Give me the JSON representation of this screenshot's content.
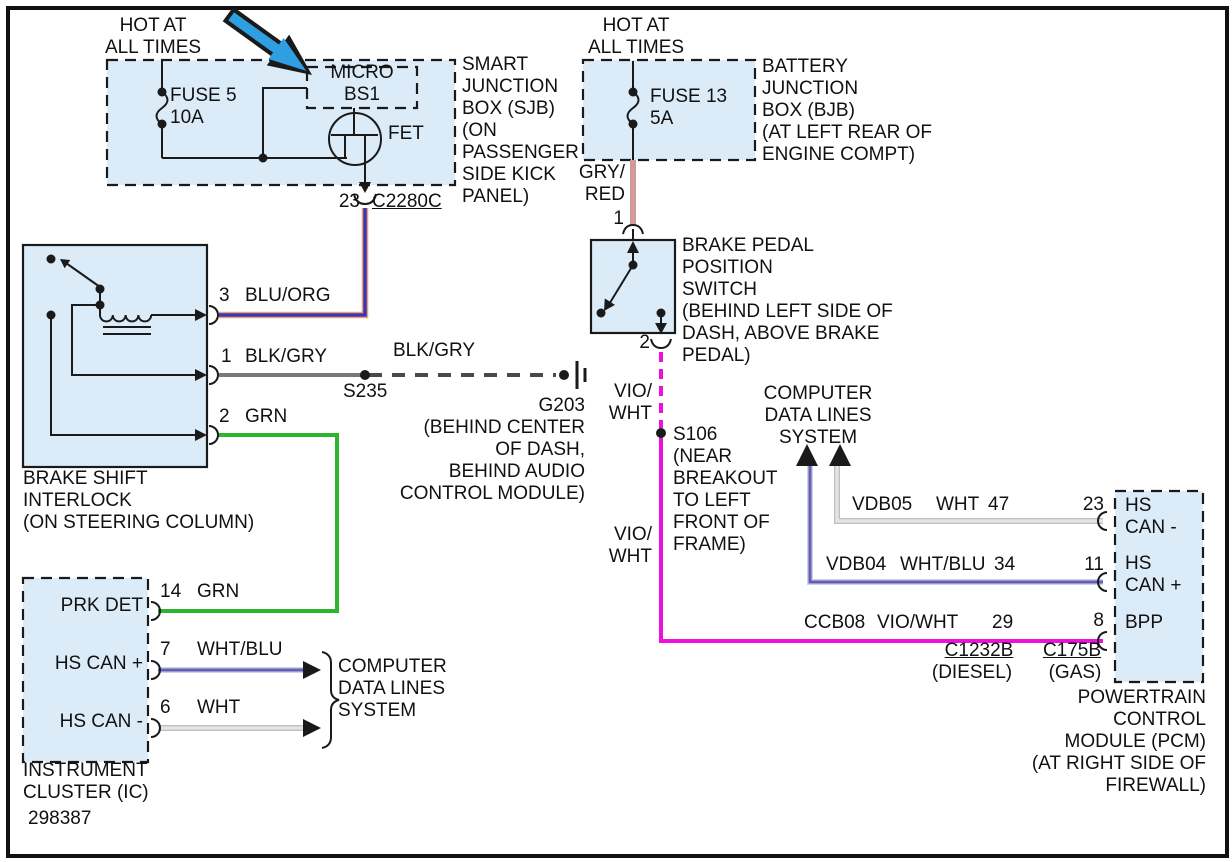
{
  "colors": {
    "line": "#1a1a1a",
    "box_fill": "#dcebf8",
    "wire_blu": "#3a35c0",
    "wire_org": "#e9a469",
    "wire_grn": "#2eb42e",
    "wire_gry": "#787878",
    "wire_blk_gry_dash": "#4a4a4a",
    "wire_gry_red": "#ea9191",
    "wire_gry_red_edge": "#a8a8a8",
    "wire_vio_wht": "#ee10dd",
    "wire_wht": "#e4e4e4",
    "wire_wht_edge": "#bfbfbf",
    "wire_wht_blu": "#6460b4",
    "wire_wht_blu_edge": "#cfcfe8",
    "arrow_blue": "#2e9fe0"
  },
  "sheet_number": "298387",
  "hot_left": {
    "line1": "HOT AT",
    "line2": "ALL TIMES"
  },
  "hot_right": {
    "line1": "HOT AT",
    "line2": "ALL TIMES"
  },
  "sjb": {
    "fuse_name": "FUSE 5",
    "fuse_rating": "10A",
    "micro_line1": "MICRO",
    "micro_line2": "BS1",
    "fet_label": "FET",
    "name_lines": [
      "SMART",
      "JUNCTION",
      "BOX (SJB)",
      "(ON",
      "PASSENGER",
      "SIDE KICK",
      "PANEL)"
    ],
    "pin": "23",
    "connector": "C2280C"
  },
  "bjb": {
    "fuse_name": "FUSE 13",
    "fuse_rating": "5A",
    "name_lines": [
      "BATTERY",
      "JUNCTION",
      "BOX (BJB)",
      "(AT LEFT REAR OF",
      "ENGINE COMPT)"
    ],
    "wire_color_line1": "GRY/",
    "wire_color_line2": "RED",
    "pin": "1"
  },
  "bpp": {
    "pin_bottom": "2",
    "name_lines": [
      "BRAKE PEDAL",
      "POSITION",
      "SWITCH",
      "(BEHIND LEFT SIDE OF",
      "DASH, ABOVE BRAKE",
      "PEDAL)"
    ]
  },
  "vio_label_1": {
    "line1": "VIO/",
    "line2": "WHT"
  },
  "vio_label_2": {
    "line1": "VIO/",
    "line2": "WHT"
  },
  "s106": {
    "lines": [
      "S106",
      "(NEAR",
      "BREAKOUT",
      "TO LEFT",
      "FRONT OF",
      "FRAME)"
    ]
  },
  "s235": {
    "label": "S235"
  },
  "blk_gry_label": "BLK/GRY",
  "g203": {
    "lines": [
      "G203",
      "(BEHIND CENTER",
      "OF DASH,",
      "BEHIND AUDIO",
      "CONTROL MODULE)"
    ]
  },
  "cdl_top": {
    "lines": [
      "COMPUTER",
      "DATA LINES",
      "SYSTEM"
    ]
  },
  "cdl_bottom": {
    "lines": [
      "COMPUTER",
      "DATA LINES",
      "SYSTEM"
    ]
  },
  "pcm": {
    "rows": [
      {
        "circuit": "VDB05",
        "color": "WHT",
        "pin_left": "47",
        "pin_right": "23",
        "label1": "HS",
        "label2": "CAN -"
      },
      {
        "circuit": "VDB04",
        "color": "WHT/BLU",
        "pin_left": "34",
        "pin_right": "11",
        "label1": "HS",
        "label2": "CAN +"
      },
      {
        "circuit": "CCB08",
        "color": "VIO/WHT",
        "pin_left": "29",
        "pin_right": "8",
        "label1": "BPP",
        "label2": ""
      }
    ],
    "connector_left": "C1232B",
    "connector_left_sub": "(DIESEL)",
    "connector_right": "C175B",
    "connector_right_sub": "(GAS)",
    "name_lines": [
      "POWERTRAIN",
      "CONTROL",
      "MODULE (PCM)",
      "(AT RIGHT SIDE OF",
      "FIREWALL)"
    ]
  },
  "interlock": {
    "pins": [
      {
        "num": "3",
        "color": "BLU/ORG"
      },
      {
        "num": "1",
        "color": "BLK/GRY"
      },
      {
        "num": "2",
        "color": "GRN"
      }
    ],
    "name_lines": [
      "BRAKE SHIFT",
      "INTERLOCK",
      "(ON STEERING COLUMN)"
    ]
  },
  "ic": {
    "pins": [
      {
        "label": "PRK DET",
        "num": "14",
        "color": "GRN"
      },
      {
        "label": "HS CAN +",
        "num": "7",
        "color": "WHT/BLU"
      },
      {
        "label": "HS CAN -",
        "num": "6",
        "color": "WHT"
      }
    ],
    "name_lines": [
      "INSTRUMENT",
      "CLUSTER (IC)"
    ]
  }
}
